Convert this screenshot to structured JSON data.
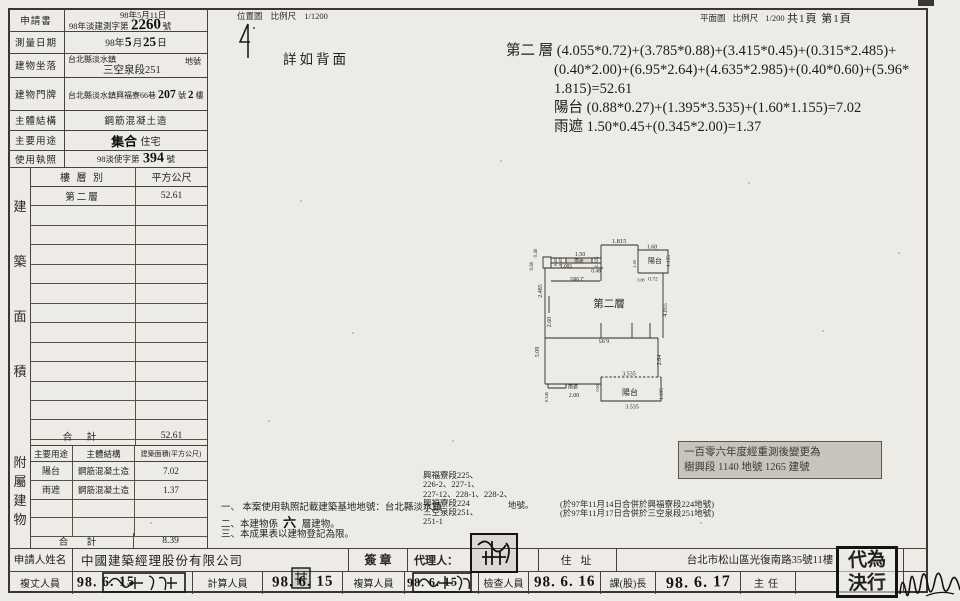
{
  "top_strip": {
    "loc_map": "位置圖",
    "loc_scale_label": "比例尺",
    "loc_scale": "1/1200",
    "plan_map": "平面圖",
    "plan_scale_label": "比例尺",
    "plan_scale": "1/200",
    "page_count": "共1頁 第1頁",
    "detail_note": "詳如背面"
  },
  "fields": {
    "application": {
      "label": "申請書",
      "date": "98年5月11日",
      "doc_prefix": "98年淡建測字第",
      "doc_number": "2260",
      "doc_suffix": "號"
    },
    "survey_date": {
      "label": "測量日期",
      "prefix": "98年",
      "month": "5",
      "month_unit": "月",
      "day": "25",
      "day_unit": "日"
    },
    "location": {
      "label": "建物坐落",
      "line1": "台北縣淡水鎮",
      "line2": "三空泉段251",
      "suffix": "地號"
    },
    "address": {
      "label": "建物門牌",
      "prefix": "台北縣淡水鎮興福寮66巷",
      "number": "207",
      "number_unit": "號",
      "floor": "2",
      "floor_unit": "樓"
    },
    "structure": {
      "label": "主體結構",
      "value": "鋼筋混凝土造"
    },
    "usage": {
      "label": "主要用途",
      "hw": "集合",
      "value": "住宅"
    },
    "license": {
      "label": "使用執照",
      "prefix": "98淡使字第",
      "number": "394",
      "suffix": "號"
    }
  },
  "area_table": {
    "side_label": "建築面積",
    "col1": "樓 層 別",
    "col2": "平方公尺",
    "rows": [
      {
        "floor": "第二層",
        "area": "52.61"
      }
    ],
    "empty_rows": 12,
    "total_label": "合  計",
    "total": "52.61"
  },
  "annex_table": {
    "side_label": "附屬建物",
    "col1": "主要用途",
    "col2": "主體結構",
    "col3": "建築面積(平方公尺)",
    "rows": [
      {
        "use": "陽台",
        "structure": "鋼筋混凝土造",
        "area": "7.02"
      },
      {
        "use": "雨遮",
        "structure": "鋼筋混凝土造",
        "area": "1.37"
      }
    ],
    "empty_rows": 2,
    "total_label": "合 計",
    "total": "8.39"
  },
  "formulas": {
    "lines": [
      "第二 層 (4.055*0.72)+(3.785*0.88)+(3.415*0.45)+(0.315*2.485)+",
      "(0.40*2.00)+(6.95*2.64)+(4.635*2.985)+(0.40*0.60)+(5.96*",
      "1.815)=52.61",
      "陽台 (0.88*0.27)+(1.395*3.535)+(1.60*1.155)=7.02",
      "雨遮 1.50*0.45+(0.345*2.00)=1.37"
    ]
  },
  "plan": {
    "labels": [
      {
        "t": "1.815",
        "x": 619,
        "y": 243,
        "s": 6.5
      },
      {
        "t": "0.40",
        "x": 537,
        "y": 253,
        "r": -90,
        "s": 5
      },
      {
        "t": "0.60",
        "x": 533,
        "y": 266,
        "r": -90,
        "s": 5
      },
      {
        "t": "0.45",
        "x": 557,
        "y": 262,
        "r": -90,
        "s": 4.6
      },
      {
        "t": "0.45",
        "x": 562,
        "y": 262,
        "r": -90,
        "s": 4.6
      },
      {
        "t": "1.50",
        "x": 580,
        "y": 256,
        "s": 6
      },
      {
        "t": "雨遮",
        "x": 579,
        "y": 262.6,
        "s": 4.6
      },
      {
        "t": "1.325",
        "x": 598,
        "y": 262,
        "r": -90,
        "s": 4.8
      },
      {
        "t": "1.005",
        "x": 566,
        "y": 267.5,
        "s": 5.4
      },
      {
        "t": "0.48",
        "x": 596,
        "y": 272.5,
        "s": 5.4
      },
      {
        "t": "2.985",
        "x": 577,
        "y": 277,
        "r": 180,
        "s": 6
      },
      {
        "t": "2.485",
        "x": 542,
        "y": 291,
        "r": -90,
        "s": 6
      },
      {
        "t": "1.60",
        "x": 652,
        "y": 248.5,
        "s": 6
      },
      {
        "t": "陽台",
        "x": 655,
        "y": 263,
        "s": 7
      },
      {
        "t": "1.155",
        "x": 670,
        "y": 261,
        "r": -90,
        "s": 5.2
      },
      {
        "t": "1.49",
        "x": 636,
        "y": 264,
        "r": -90,
        "s": 4.4
      },
      {
        "t": "0.88",
        "x": 641,
        "y": 281.5,
        "s": 4
      },
      {
        "t": "0.72",
        "x": 653,
        "y": 280.5,
        "s": 5.4
      },
      {
        "t": "第二層",
        "x": 609,
        "y": 307,
        "s": 10.5
      },
      {
        "t": "4.055",
        "x": 667,
        "y": 310,
        "r": -90,
        "s": 6
      },
      {
        "t": "2.60",
        "x": 551,
        "y": 322,
        "r": -90,
        "s": 6
      },
      {
        "t": "5.09",
        "x": 539,
        "y": 352,
        "r": -90,
        "s": 6
      },
      {
        "t": "6.95",
        "x": 604,
        "y": 339,
        "r": 180,
        "s": 6
      },
      {
        "t": "2.64",
        "x": 661,
        "y": 360,
        "r": -90,
        "s": 6
      },
      {
        "t": "3.535",
        "x": 629,
        "y": 375.5,
        "s": 6
      },
      {
        "t": "陽台",
        "x": 630,
        "y": 395,
        "s": 8
      },
      {
        "t": "1.395",
        "x": 663,
        "y": 394,
        "r": -90,
        "s": 5.2
      },
      {
        "t": "3.535",
        "x": 632,
        "y": 408.5,
        "s": 6
      },
      {
        "t": "雨遮",
        "x": 573,
        "y": 388.5,
        "s": 5
      },
      {
        "t": "2.00",
        "x": 574,
        "y": 397,
        "s": 6
      },
      {
        "t": "0.345",
        "x": 548,
        "y": 397,
        "r": -90,
        "s": 4.6
      },
      {
        "t": "0.60",
        "x": 599,
        "y": 388,
        "r": -90,
        "s": 4
      }
    ]
  },
  "restamp": {
    "line1": "一百零六年度經重測後變更為",
    "line2": "樹興段 1140 地號 1265 建號"
  },
  "notes": {
    "n1": "一、 本案使用執照記載建築基地地號：台北縣淡水鎮",
    "n2_pre": "二、本建物係",
    "n2_hw": "六",
    "n2_post": "層建物。",
    "n3": "三、本成果表以建物登記為限。",
    "lots": [
      "興福寮段225、",
      "226-2、227-1、",
      "227-12、228-1、228-2、",
      "興福寮段224",
      "三空泉段251、",
      "251-1"
    ],
    "lot_unit": "地號。",
    "remark1": "(於97年11月14日合併於興福寮段224地號)",
    "remark2": "(於97年11月17日合併於三空泉段251地號)"
  },
  "applicant_row": {
    "label": "申請人姓名",
    "name": "中國建築經理股份有限公司",
    "sign": "簽  章",
    "agent": "代理人：",
    "addr_label": "住 址",
    "address": "台北市松山區光復南路35號11樓"
  },
  "personnel": {
    "p0": {
      "label": "複丈人員",
      "date": "98. 6. 15"
    },
    "p1": {
      "label": "計算人員",
      "date": "98. 6. 15"
    },
    "p2": {
      "label": "複算人員",
      "date": "98. 6. 15"
    },
    "p3": {
      "label": "檢查人員",
      "date": "98. 6. 16"
    },
    "p4": {
      "label": "課(股)長",
      "date": "98. 6. 17"
    },
    "p5": {
      "label": "主任",
      "date": ""
    }
  },
  "decision_stamp": {
    "line1": "代為",
    "line2": "決行"
  }
}
